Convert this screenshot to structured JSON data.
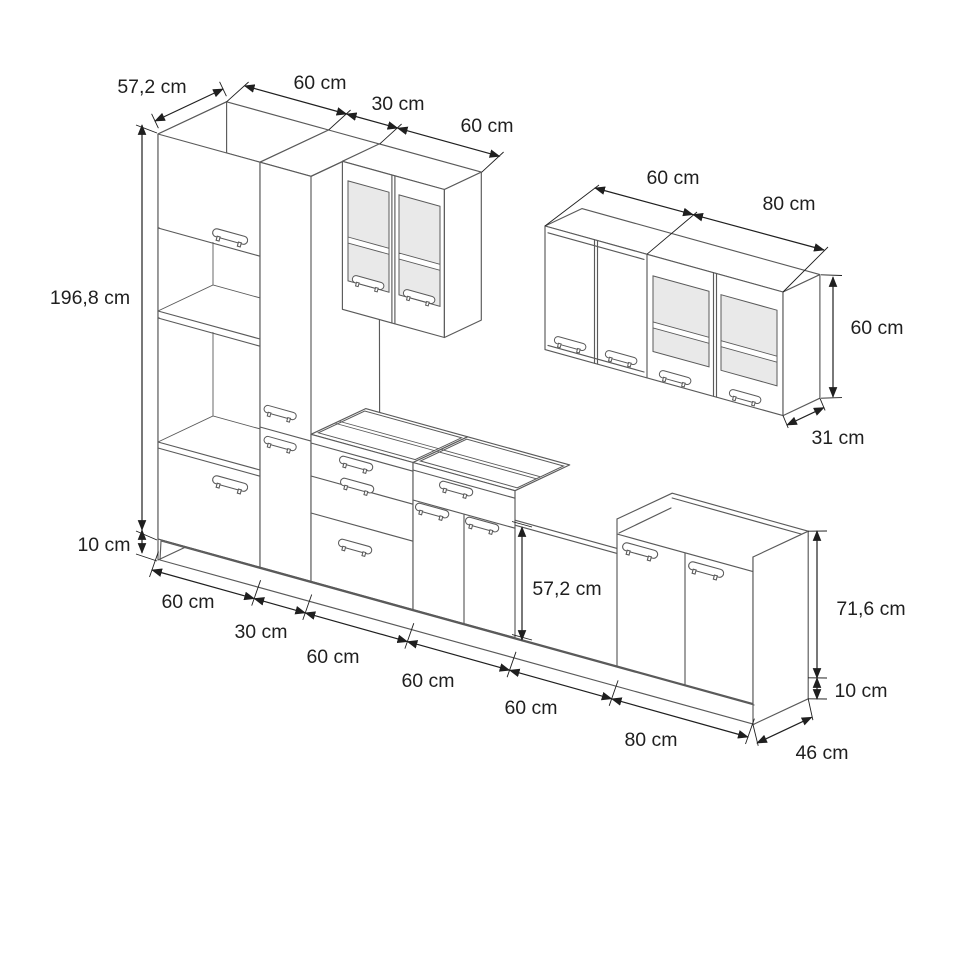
{
  "diagram": {
    "unit": "cm"
  },
  "colors": {
    "background": "#ffffff",
    "cabinet_line": "#5a5a5a",
    "dimension_line": "#1f1f1f",
    "glass_fill": "#e9e9e9",
    "text": "#1f1f1f"
  },
  "labels": {
    "tall_depth": "57,2 cm",
    "tall_w1": "60 cm",
    "tall_w2": "30 cm",
    "wall_left_w": "60 cm",
    "tall_height": "196,8 cm",
    "plinth_left": "10 cm",
    "wall_right_w1": "60 cm",
    "wall_right_w2": "80 cm",
    "wall_right_h": "60 cm",
    "wall_right_d": "31 cm",
    "niche_h": "57,2 cm",
    "base_h": "71,6 cm",
    "plinth_right": "10 cm",
    "run_w1": "60 cm",
    "run_w2": "30 cm",
    "run_w3": "60 cm",
    "run_w4": "60 cm",
    "run_w5": "60 cm",
    "run_w6": "80 cm",
    "base_d": "46 cm"
  }
}
